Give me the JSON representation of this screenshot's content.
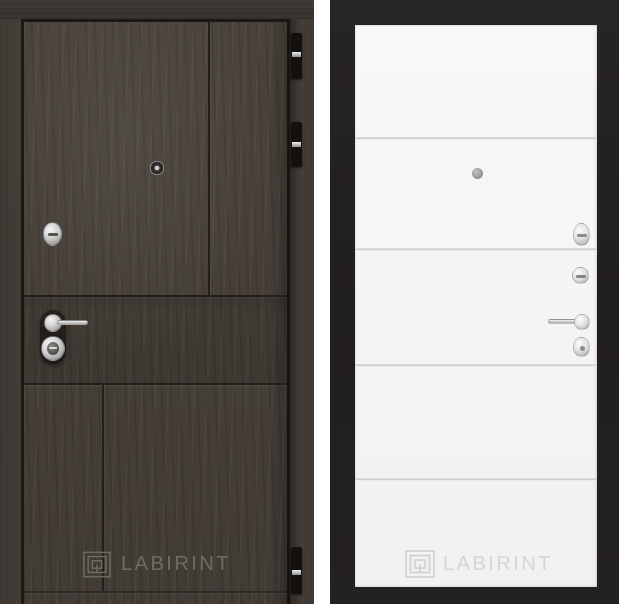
{
  "page": {
    "description": "Product photo of a LABIRINT entry door shown in two views: dark wood exterior (left) and white interior leaf in black frame (right)",
    "background_color": "#ffffff"
  },
  "left_door": {
    "view": "exterior-dark-wood",
    "colors": {
      "wood": "#463f3a",
      "top_rail": "#3c3733",
      "groove": "#231e1a",
      "hardware_chrome": "#cccccc",
      "hinge": "#131010"
    },
    "hardware": [
      "peephole",
      "cylinder-escutcheon",
      "lever-handle",
      "keyhole-escutcheon",
      "hinge-top",
      "hinge-upper",
      "hinge-bottom"
    ],
    "watermark": {
      "logo": "labyrinth-logo-icon",
      "text": "LABIRINT",
      "color": "#6f6963"
    }
  },
  "right_door": {
    "view": "interior-white",
    "colors": {
      "frame": "#232020",
      "leaf": "#f5f5f4",
      "seam": "#cfcfcd",
      "hardware_chrome": "#d6d6d6"
    },
    "seam_count": 4,
    "hardware": [
      "peephole",
      "latch-knob",
      "thumbturn",
      "lever-handle",
      "escutcheon"
    ],
    "watermark": {
      "logo": "labyrinth-logo-icon",
      "text": "LABIRINT",
      "color": "#d5d5d3"
    }
  }
}
